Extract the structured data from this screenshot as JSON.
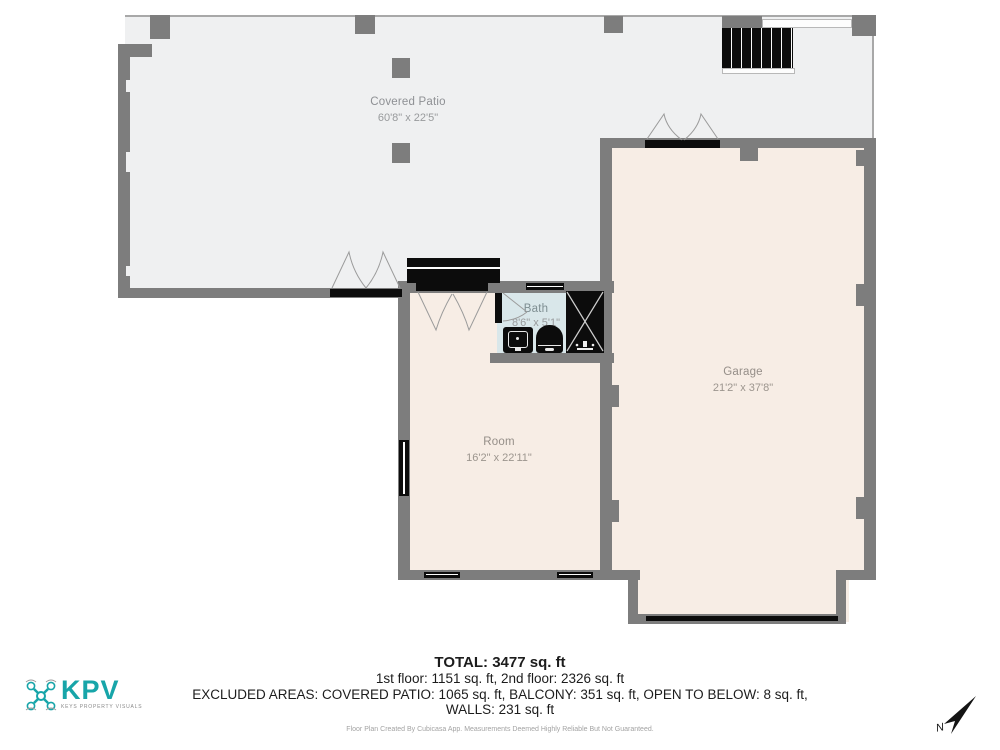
{
  "floor_plan": {
    "rooms": [
      {
        "name": "Covered Patio",
        "dims": "60'8\" x 22'5\""
      },
      {
        "name": "Garage",
        "dims": "21'2\" x 37'8\""
      },
      {
        "name": "Room",
        "dims": "16'2\" x 22'11\""
      },
      {
        "name": "Bath",
        "dims": "8'6\" x 5'1\""
      }
    ],
    "colors": {
      "wall": "#7d7d7d",
      "patio_fill": "#eff0f1",
      "interior_fill": "#f7ede5",
      "bath_fill": "#d9e7ea",
      "fixture_black": "#0c0c0c",
      "accent_teal": "#17a5a9"
    }
  },
  "summary": {
    "total": "TOTAL: 3477 sq. ft",
    "floors": "1st floor: 1151 sq. ft, 2nd floor: 2326 sq. ft",
    "excluded": "EXCLUDED AREAS: COVERED PATIO: 1065 sq. ft, BALCONY: 351 sq. ft, OPEN TO BELOW: 8 sq. ft,",
    "walls": "WALLS: 231 sq. ft"
  },
  "branding": {
    "name": "KPV",
    "tagline": "KEYS PROPERTY VISUALS"
  },
  "compass": {
    "north_label": "N"
  },
  "disclaimer": "Floor Plan Created By Cubicasa App. Measurements Deemed Highly Reliable But Not Guaranteed."
}
